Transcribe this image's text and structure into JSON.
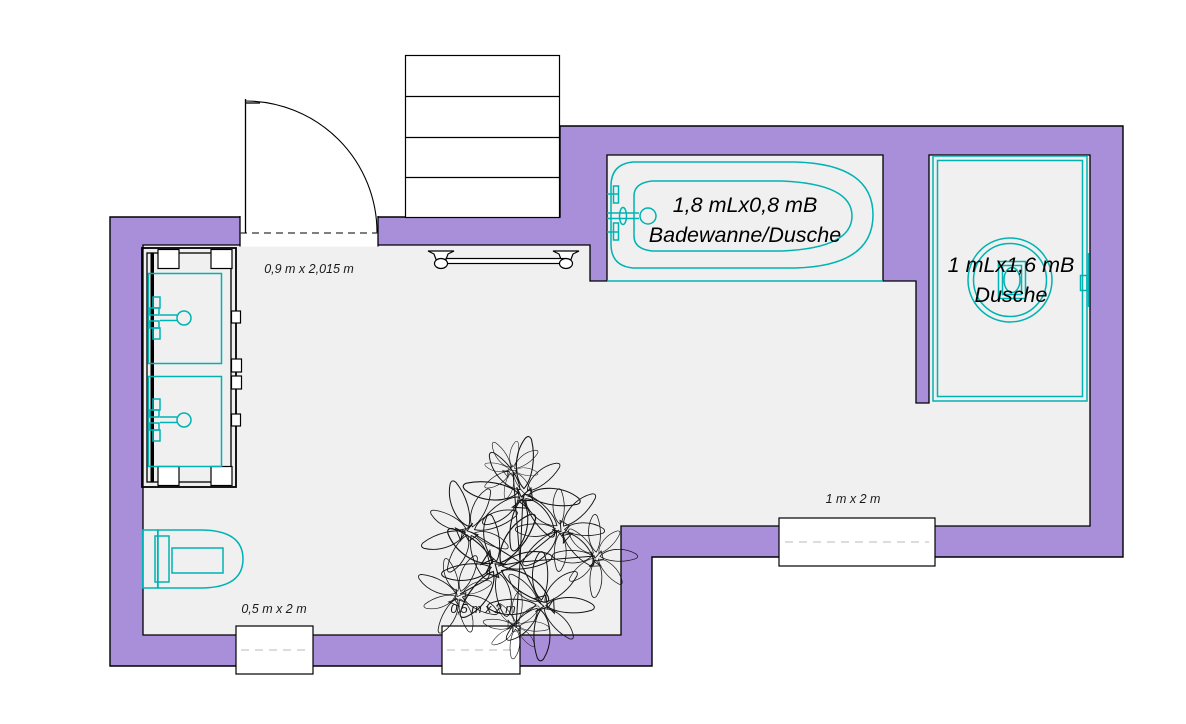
{
  "plan_labels": {
    "door_dimension": "0,9 m x 2,015 m",
    "bathtub_line1": "1,8 mLx0,8 mB",
    "bathtub_line2": "Badewanne/Dusche",
    "shower_line1": "1 mLx1,6 mB",
    "shower_line2": "Dusche",
    "window_bottom_left": "0,5 m x 2 m",
    "window_bottom_center": "0,5 m x 2 m",
    "window_bottom_right": "1 m x 2 m"
  },
  "colors": {
    "background": "#ffffff",
    "wall_fill": "#a98fda",
    "outline": "#000000",
    "floor_fill": "#f0f0f0",
    "fixture_stroke": "#00b2b2",
    "window_dash": "#d0d0d0"
  },
  "fixtures": {
    "door": "entry-door",
    "shelf": "wall-shelf",
    "towel_rail": "towel-rail",
    "bathtub": "bathtub-shower",
    "shower": "shower-enclosure",
    "vanity": "double-sink-vanity",
    "toilet": "toilet",
    "plant": "potted-plant",
    "windows": [
      "window-bottom-left",
      "window-bottom-center",
      "window-bottom-right"
    ]
  }
}
